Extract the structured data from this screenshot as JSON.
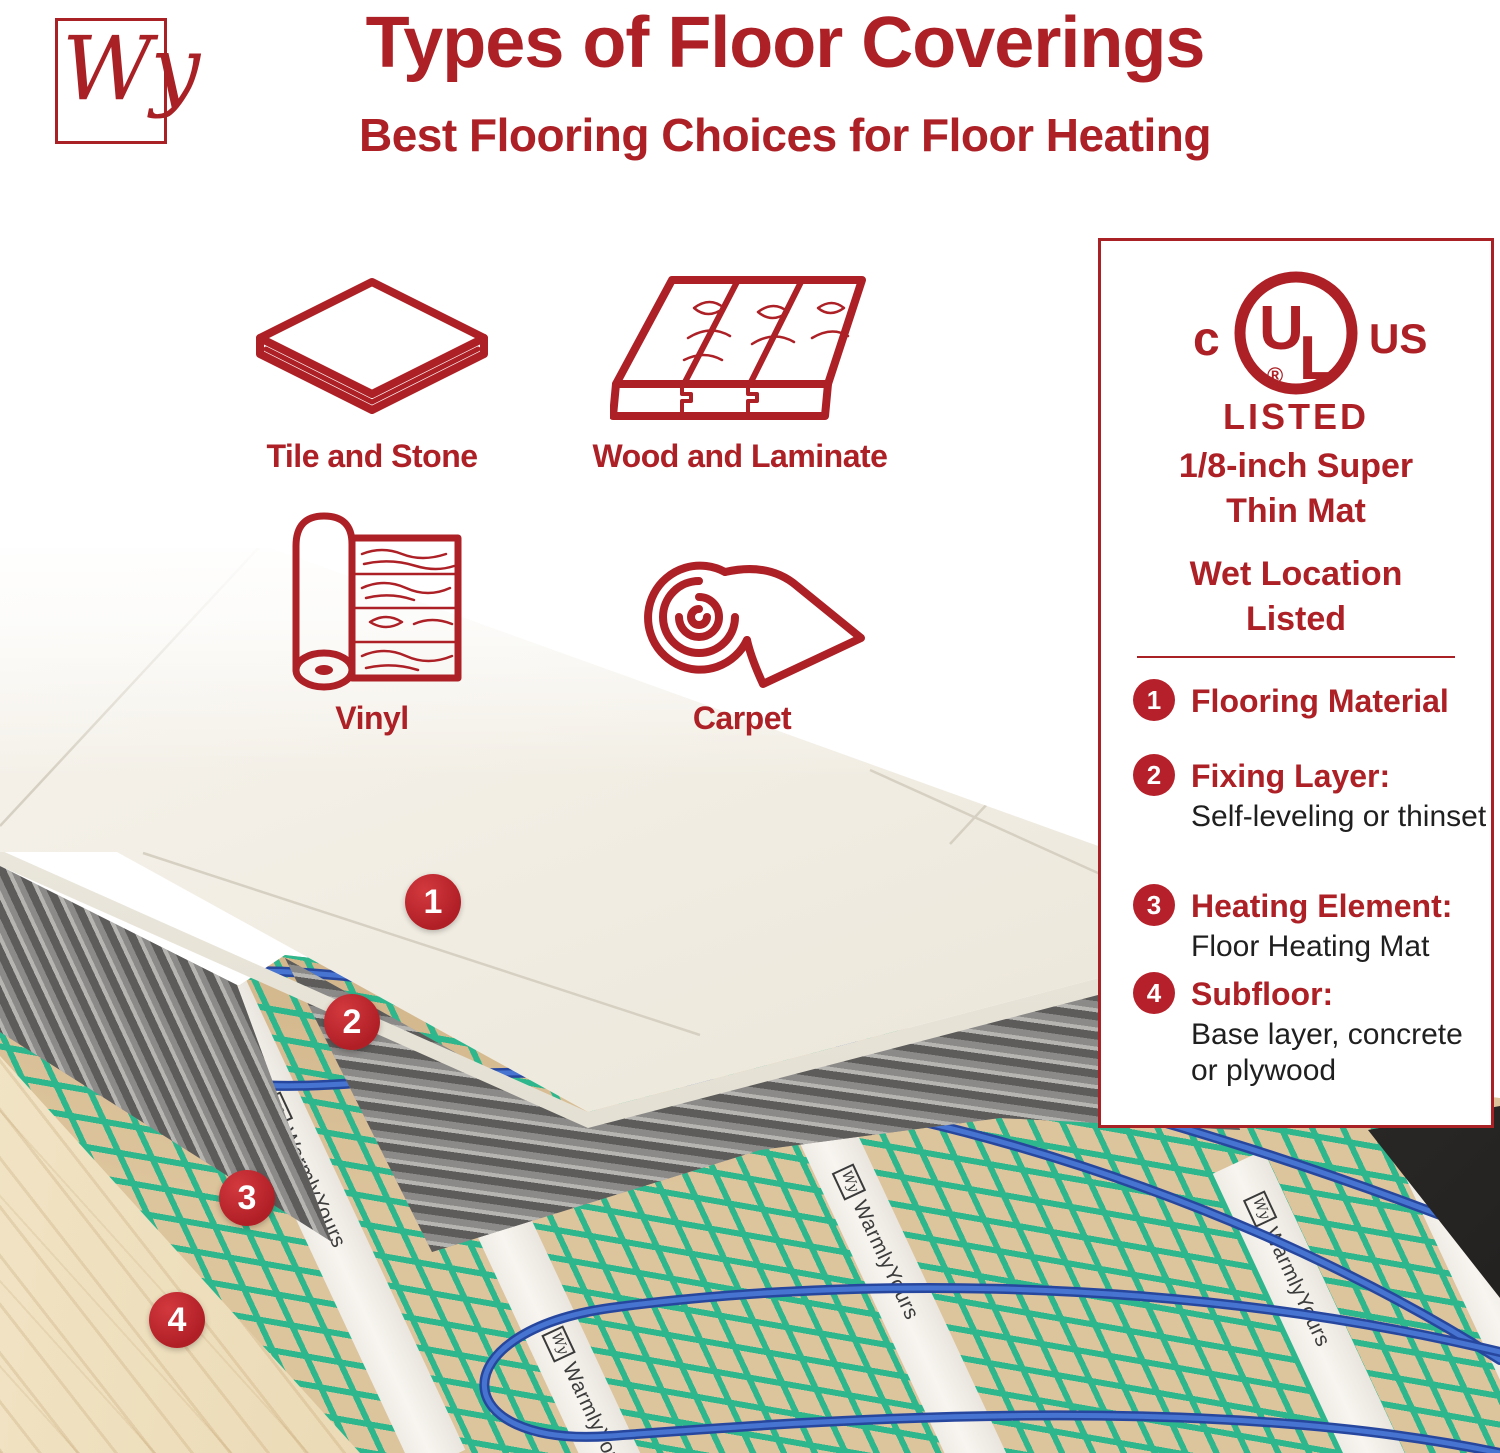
{
  "colors": {
    "brand_red": "#AC2026",
    "badge_red": "#C1272D",
    "mesh_green": "#2EB68C",
    "cable_blue": "#3E6CC8",
    "wood_tan": "#EBD8B4",
    "thinset_grey": "#8B8A88",
    "tile_cream": "#F2EEE5"
  },
  "header": {
    "logo_text": "Wy",
    "title": "Types of Floor Coverings",
    "subtitle": "Best Flooring Choices for Floor Heating"
  },
  "flooring_types": [
    {
      "label": "Tile and Stone",
      "icon": "tile-icon"
    },
    {
      "label": "Wood and Laminate",
      "icon": "wood-icon"
    },
    {
      "label": "Vinyl",
      "icon": "vinyl-icon"
    },
    {
      "label": "Carpet",
      "icon": "carpet-icon"
    }
  ],
  "cert_panel": {
    "ul_mark": {
      "prefix": "c",
      "u": "U",
      "l": "L",
      "suffix": "US",
      "registered": "®",
      "caption": "LISTED"
    },
    "feature_1_line1": "1/8-inch Super",
    "feature_1_line2": "Thin Mat",
    "feature_2_line1": "Wet Location",
    "feature_2_line2": "Listed",
    "legend": [
      {
        "num": "1",
        "title": "Flooring Material",
        "desc": ""
      },
      {
        "num": "2",
        "title": "Fixing Layer:",
        "desc": "Self-leveling or thinset"
      },
      {
        "num": "3",
        "title": "Heating Element:",
        "desc": "Floor Heating Mat"
      },
      {
        "num": "4",
        "title": "Subfloor:",
        "desc": "Base layer, concrete or plywood"
      }
    ]
  },
  "diagram": {
    "callouts": [
      "1",
      "2",
      "3",
      "4"
    ],
    "strip_brand": "WarmlyYours",
    "strip_logo": "Wy"
  }
}
